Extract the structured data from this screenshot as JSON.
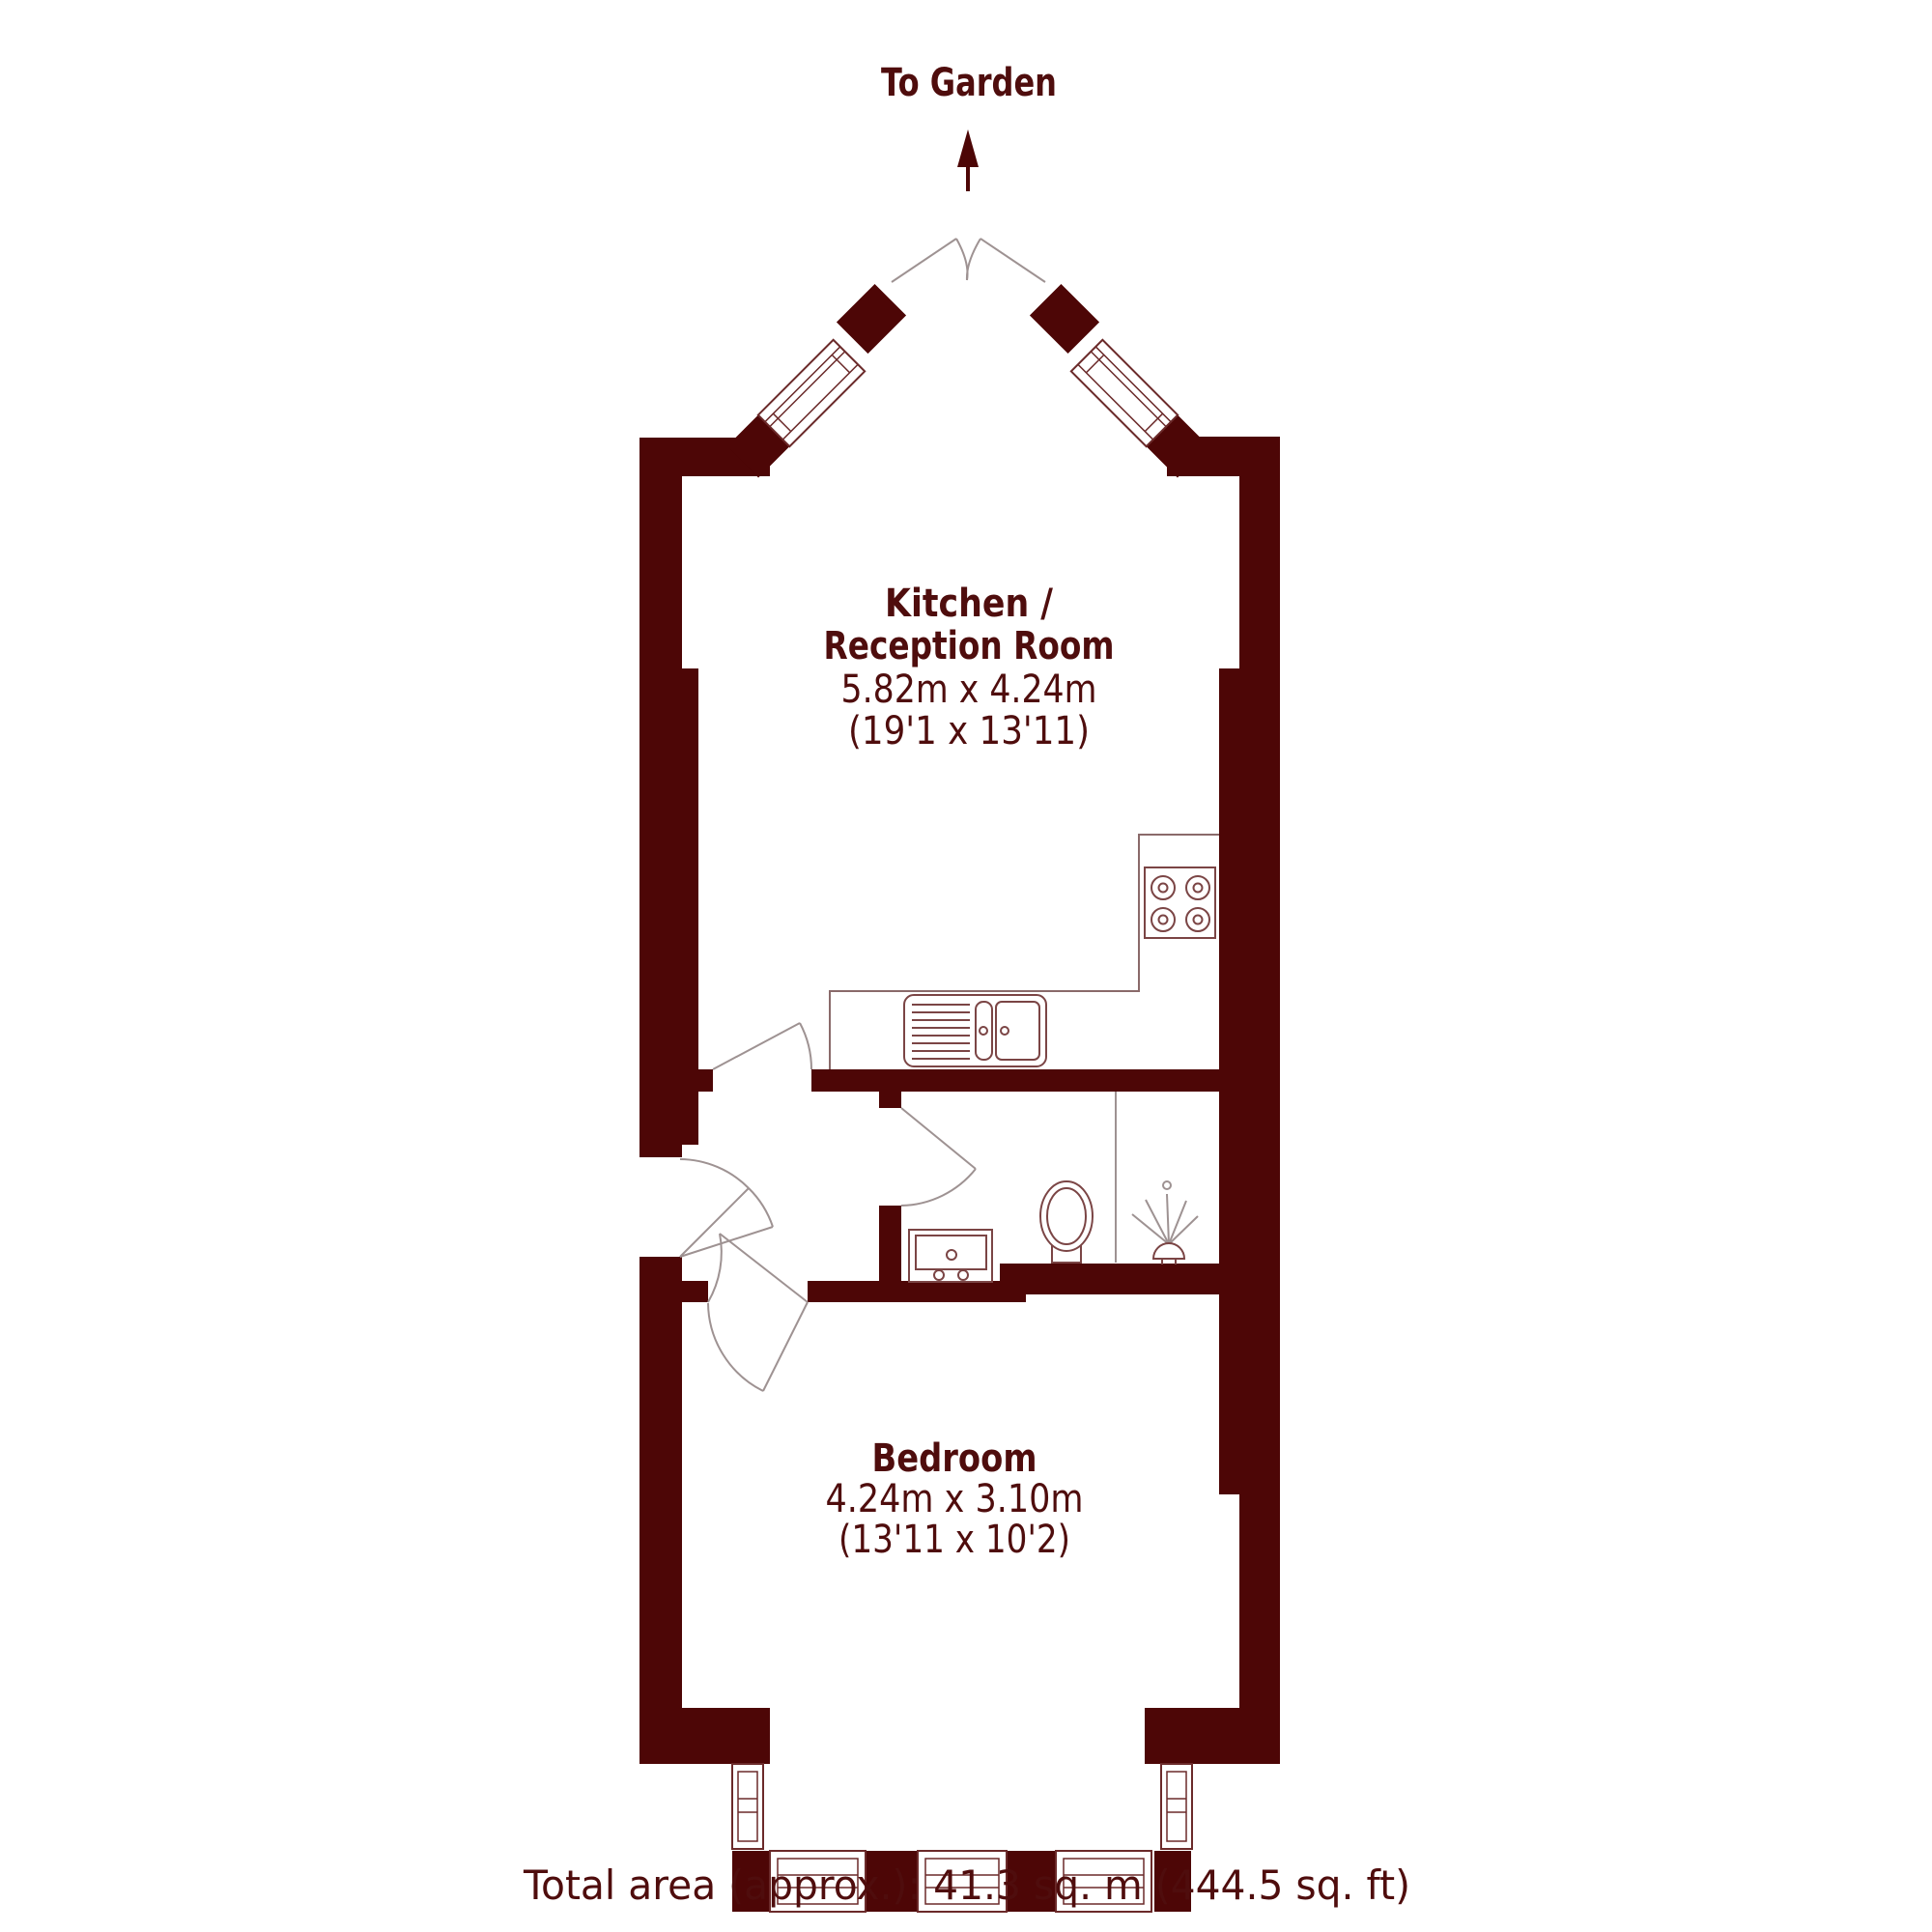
{
  "garden": {
    "label": "To Garden"
  },
  "rooms": {
    "kitchen": {
      "name_line1": "Kitchen /",
      "name_line2": "Reception Room",
      "dims_metric": "5.82m x 4.24m",
      "dims_imperial": "(19'1 x 13'11)"
    },
    "bedroom": {
      "name": "Bedroom",
      "dims_metric": "4.24m x 3.10m",
      "dims_imperial": "(13'11 x 10'2)"
    }
  },
  "footer": {
    "total_area": "Total area (approx.): 41.3 sq. m (444.5 sq. ft)"
  },
  "colors": {
    "wall": "#4d0606",
    "label_text": "#4f0d0d",
    "fixture_line": "#7b4545",
    "window_line": "#6b2a2a",
    "door_arc_line": "#9e9292",
    "background": "#ffffff"
  },
  "fixtures": {
    "kitchen": [
      "hob-4-burners",
      "sink-with-drainer",
      "worktop"
    ],
    "bathroom": [
      "toilet",
      "wash-basin",
      "shower-head",
      "shower-screen"
    ],
    "doors": [
      "front-door",
      "kitchen-door",
      "bedroom-door",
      "bathroom-door",
      "garden-french-doors-open"
    ],
    "windows": [
      "bay-window-left-angled",
      "bay-window-right-angled",
      "rear-bay-windows"
    ]
  }
}
